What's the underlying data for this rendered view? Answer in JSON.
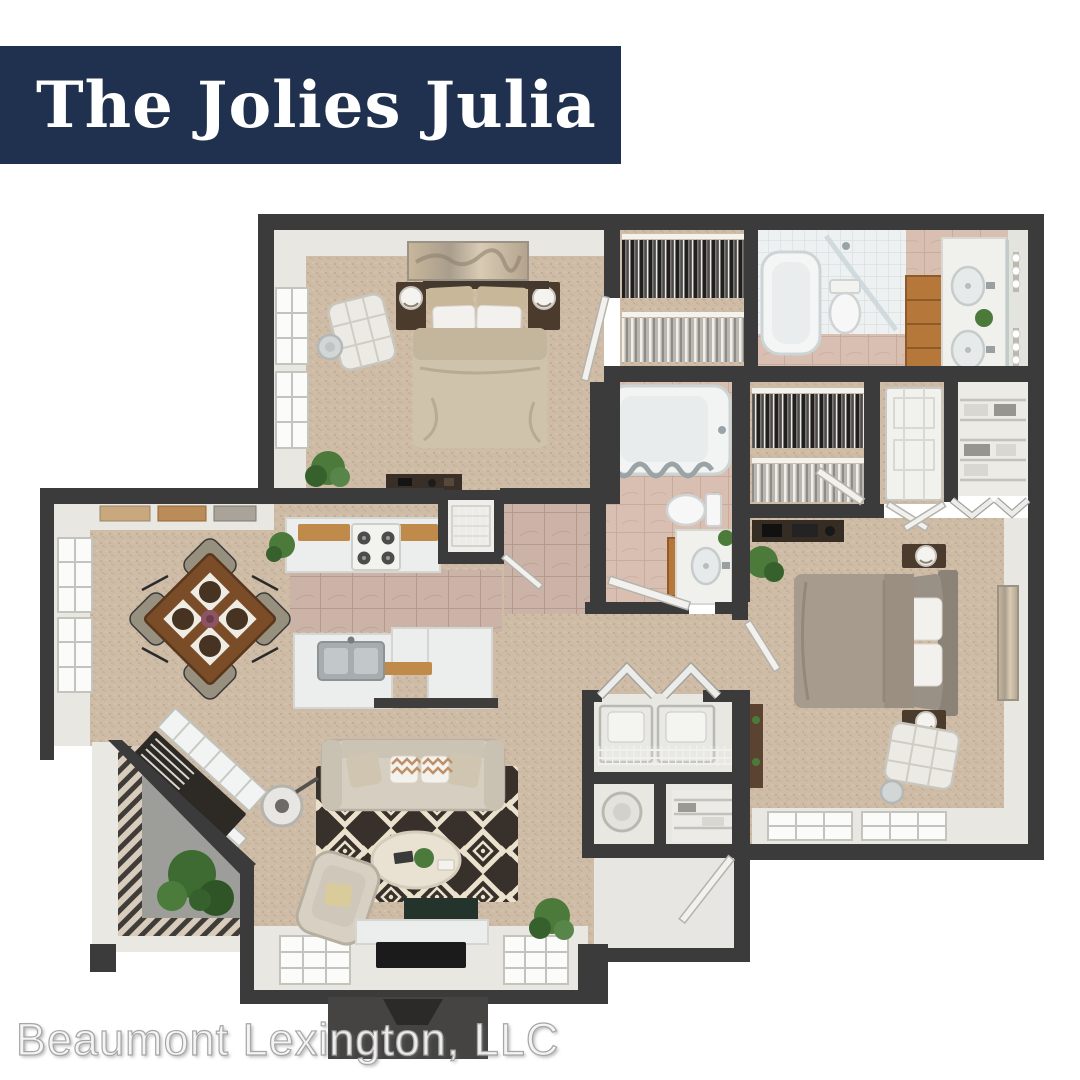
{
  "banner": {
    "title": "The Jolies Julia"
  },
  "watermark": {
    "text": "Beaumont Lexington, LLC"
  },
  "colors": {
    "banner_bg": "#20314f",
    "banner_text": "#ffffff",
    "watermark_text": "#f2f2f2",
    "wall": "#3b3b3b",
    "carpet": "#cfbca6",
    "bathroom_tile": "#d8bfb1",
    "kitchen_tile": "#ccb3a7",
    "fixture_white": "#f0f0ec",
    "cabinet_wood": "#b5773a",
    "table_wood": "#7a4c28",
    "sofa_beige": "#d6cfc1",
    "primary_bed_linen": "#cfc3ab",
    "second_bed_linen": "#a79b8d",
    "rug_dark": "#38302a",
    "rug_cream": "#ebe1cd",
    "patio_concrete": "#9d9d99",
    "foliage": "#4c7a3a"
  },
  "floor_plan": {
    "style": "3d-top-down-rendering",
    "rooms": [
      "primary-bedroom",
      "walk-in-closet-1",
      "primary-bathroom",
      "hall-bathroom",
      "walk-in-closet-2",
      "second-bedroom",
      "bedroom-2-closet",
      "kitchen",
      "pantry",
      "dining-area",
      "living-room",
      "laundry-closet",
      "water-heater-closet",
      "entry-hall",
      "patio",
      "desk-nook"
    ]
  }
}
